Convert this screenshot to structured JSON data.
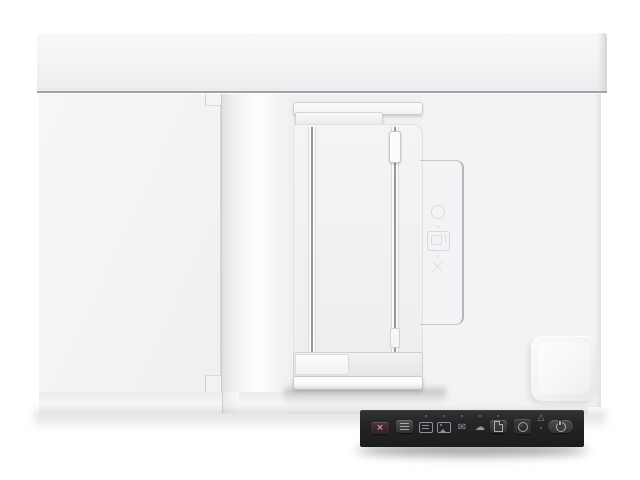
{
  "scene": {
    "type": "product-photo",
    "subject": "Top-down view of a white flatbed document scanner with automatic document feeder and dark control panel",
    "background_color": "#ffffff"
  },
  "palette": {
    "body_white": "#f3f4f5",
    "top_bar": "#f0f1f3",
    "seam_gray": "#a2a3a6",
    "recess_gray": "#eff0f1",
    "rail_dark": "#97989b",
    "panel_dark": "#232427",
    "button_dark": "#3a3b3d",
    "cancel_tint": "#4b3336",
    "icon_gray": "#939497",
    "led_gray": "#6a6b6e",
    "shadow_gray": "#c9cacc"
  },
  "device": {
    "parts": [
      "rear-hinge-bar",
      "flatbed-lid",
      "lid-hinge-strip",
      "adf-input-tray",
      "paper-width-guides",
      "guide-rails",
      "bottom-paper-guide",
      "service-door-seam",
      "embossed-instruction-icons",
      "corner-latch-bump",
      "control-panel"
    ],
    "embossed_icons": [
      {
        "name": "rotate-circle-icon"
      },
      {
        "name": "paper-stack-icon"
      },
      {
        "name": "cross-arrows-icon"
      }
    ]
  },
  "control_panel": {
    "buttons": [
      {
        "id": "cancel",
        "icon": "cancel-x-icon",
        "glyph": "×"
      },
      {
        "id": "feed-mode",
        "icon": "lines-icon"
      },
      {
        "id": "dest-pdf",
        "icon": "pdf-file-icon",
        "led": true
      },
      {
        "id": "dest-image",
        "icon": "image-icon",
        "led": true
      },
      {
        "id": "dest-email",
        "icon": "envelope-icon",
        "glyph": "✉",
        "led": true
      },
      {
        "id": "dest-cloud",
        "icon": "cloud-icon",
        "glyph": "☁",
        "led": true
      },
      {
        "id": "scan",
        "icon": "document-icon",
        "led": true
      },
      {
        "id": "settings",
        "icon": "gear-circle-icon"
      },
      {
        "id": "warning",
        "icon": "warning-triangle-icon",
        "glyph": "△",
        "led": true
      },
      {
        "id": "power",
        "icon": "power-icon"
      }
    ]
  }
}
